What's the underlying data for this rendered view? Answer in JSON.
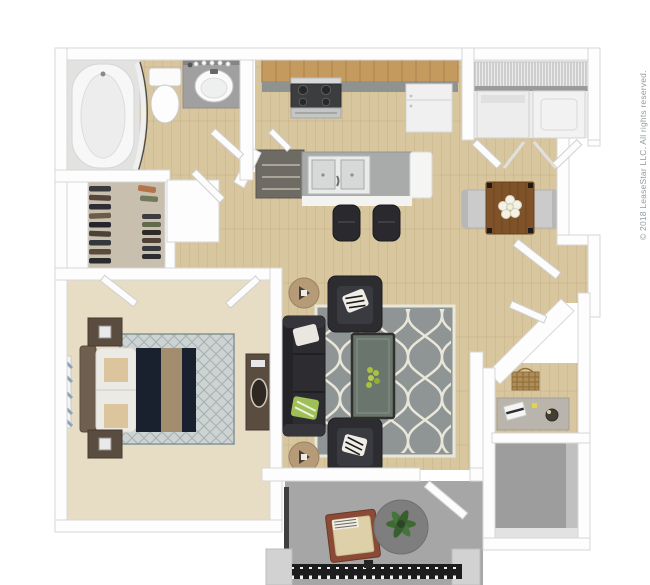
{
  "copyright": "© 2018 LeaseStar LLC. All rights reserved.",
  "palette": {
    "page_bg": "#ffffff",
    "wall": "#fdfdfd",
    "wall_edge": "#d7d7d7",
    "floor_wood": "#d8c69e",
    "carpet_bedroom": "#e7dcc4",
    "carpet_closet": "#c9bfae",
    "concrete_patio": "#a6a6a6",
    "concrete_storage": "#9d9d9d",
    "tile_bath": "#e2e2e0",
    "counter_wood": "#c59a5f",
    "counter_island": "#a9abab",
    "appliance_white": "#f0f0f0",
    "sofa_dark": "#2c2c31",
    "rug_gray": "#8f9595",
    "rug_cream": "#e9e6da",
    "bed_navy": "#19212f",
    "bed_runner": "#a28e6f",
    "bed_rug": "#ccd3d2",
    "wood_dark_furniture": "#5a4c3f",
    "table_brown": "#7f5229",
    "chair_gray": "#cbcbcb",
    "plant_green": "#3f6b33",
    "accent_green": "#a6c23f",
    "patio_chair": "#8a4a35",
    "patio_cushion": "#ded0a8",
    "patio_rug": "#7e7e7e",
    "railing_dark": "#1d1d1d",
    "copyright_color": "#939ba1"
  }
}
